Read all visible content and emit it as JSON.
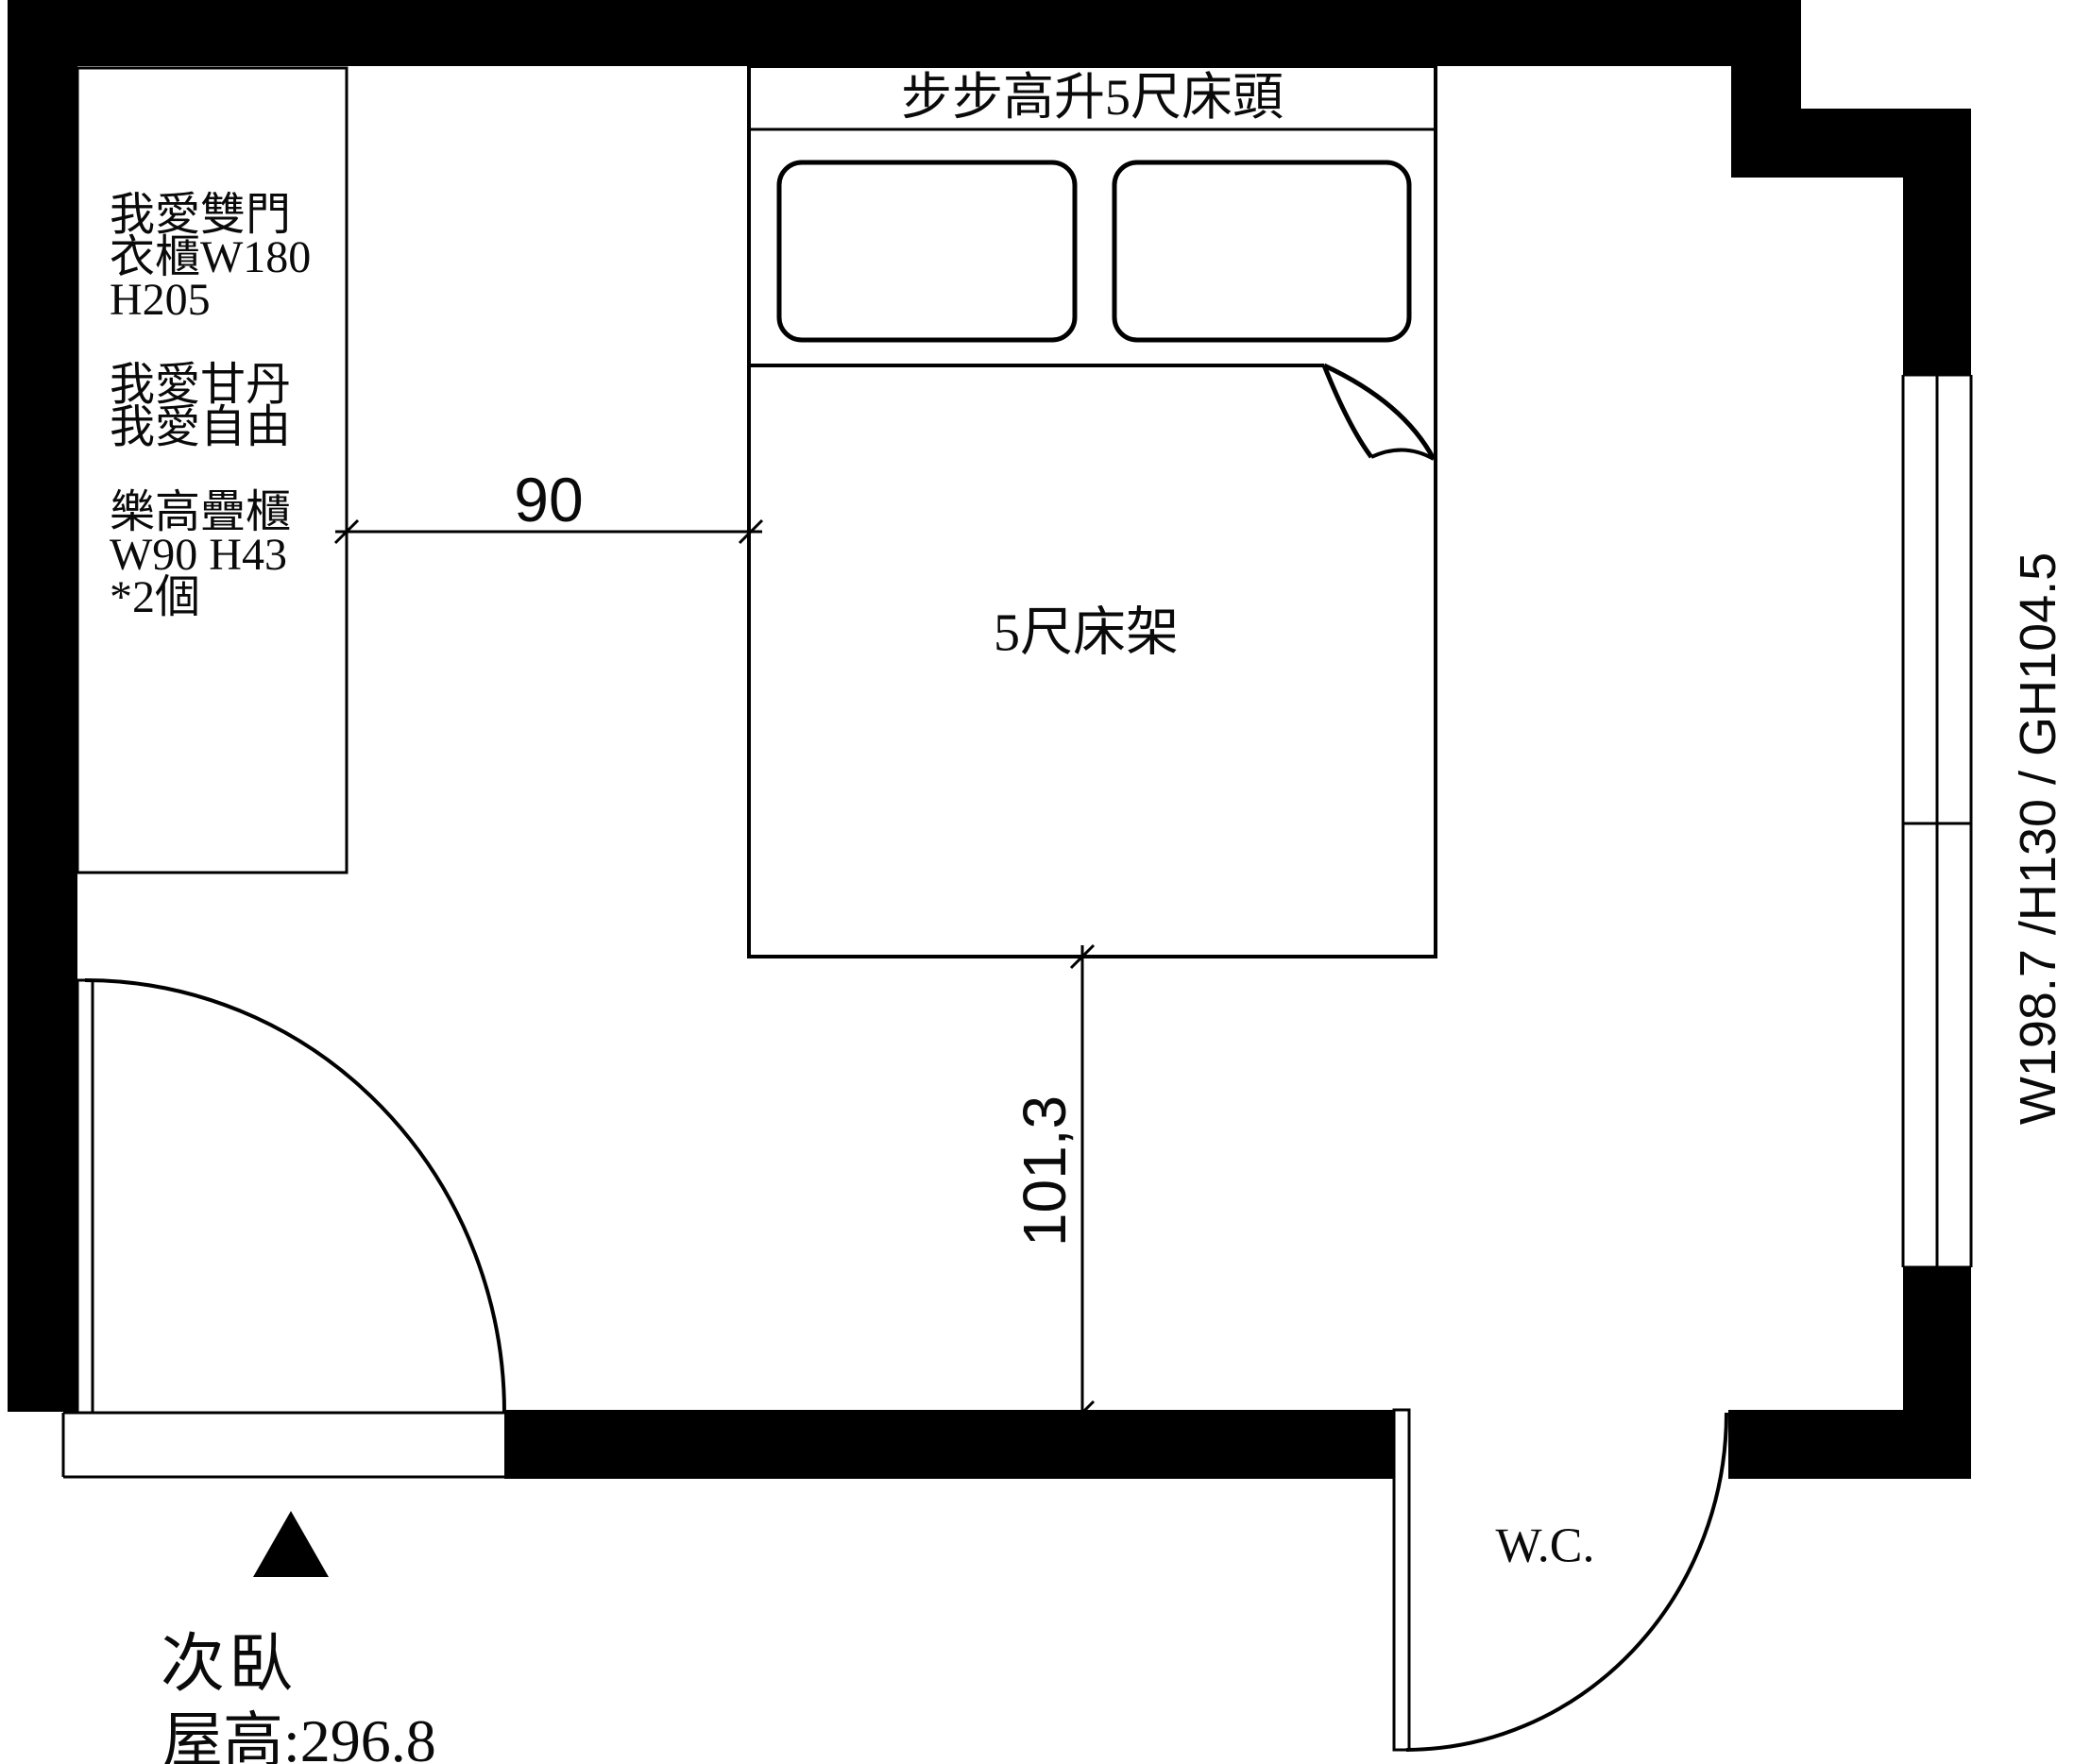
{
  "labels": {
    "headboard": "步步高升5尺床頭",
    "bed": "5尺床架",
    "wc": "W.C.",
    "room_name": "次臥",
    "ceiling_height": "屋高:296.8",
    "window_spec": "W198.7 /H130 / GH104.5",
    "wardrobe_note": "我愛雙門\n衣櫃W180\nH205\n\n我愛甘丹\n我愛自由\n\n樂高疊櫃\nW90 H43\n*2個"
  },
  "dimensions": {
    "wardrobe_to_bed": "90",
    "bed_to_wall": "101,3"
  },
  "colors": {
    "wall": "#000000",
    "line": "#000000",
    "background": "#ffffff"
  }
}
